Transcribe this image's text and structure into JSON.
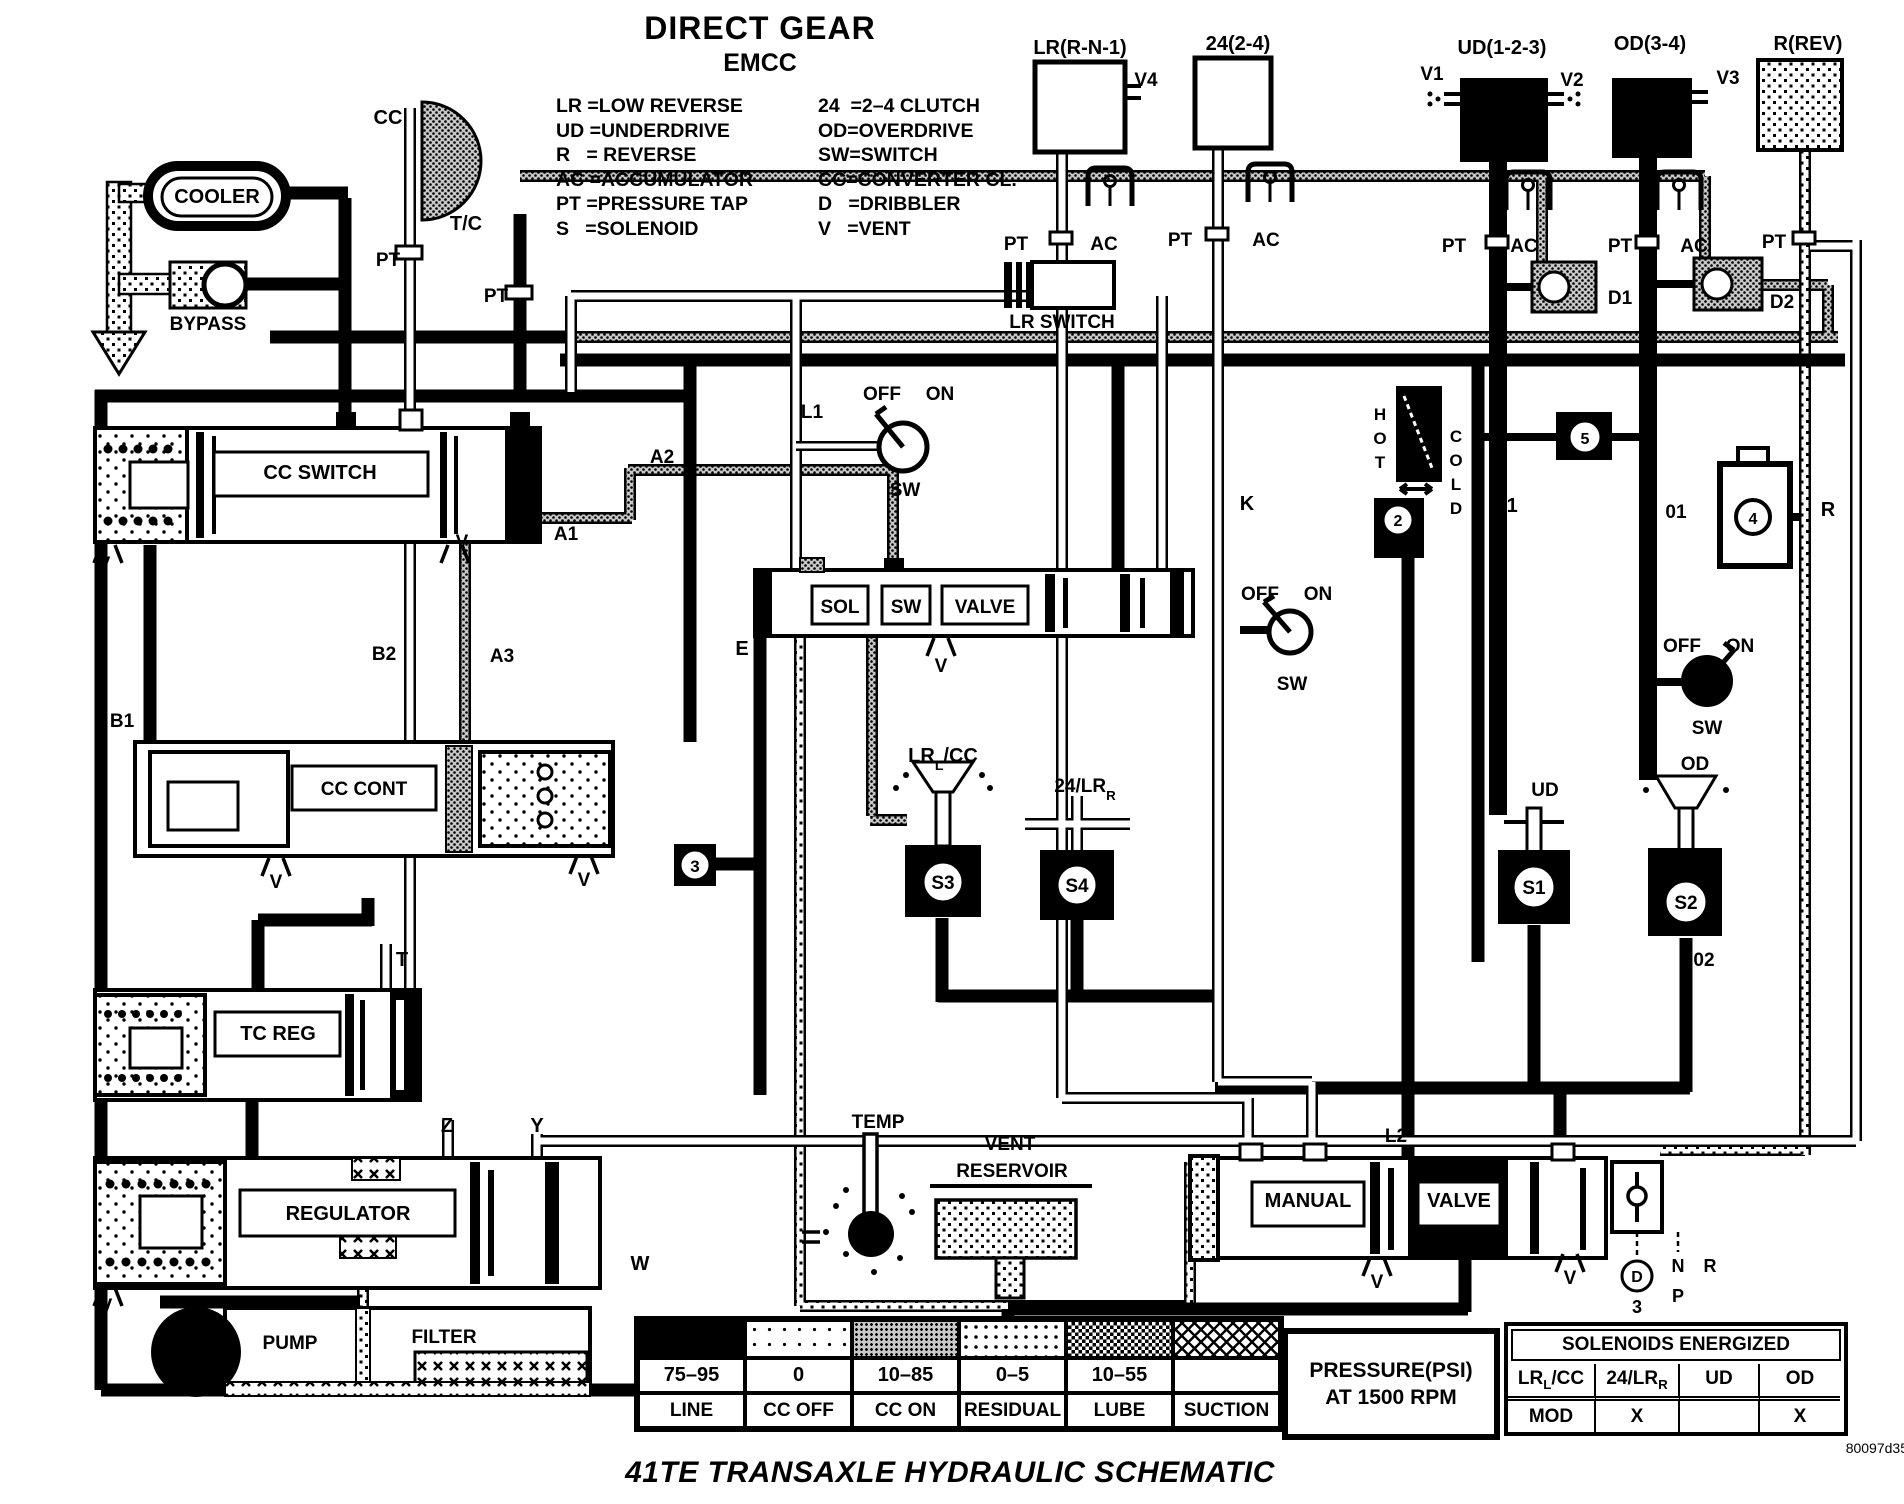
{
  "title": {
    "main": "DIRECT GEAR",
    "sub": "EMCC"
  },
  "legend": {
    "col1": [
      "LR =LOW REVERSE",
      "UD =UNDERDRIVE",
      "R   = REVERSE",
      "AC =ACCUMULATOR",
      "PT =PRESSURE TAP",
      "S   =SOLENOID"
    ],
    "col2": [
      "24  =2–4 CLUTCH",
      "OD=OVERDRIVE",
      "SW=SWITCH",
      "CC=CONVERTER CL.",
      "D   =DRIBBLER",
      "V   =VENT"
    ]
  },
  "pressure_table": {
    "title1": "PRESSURE(PSI)",
    "title2": "AT 1500 RPM",
    "columns": [
      {
        "value": "75–95",
        "label": "LINE",
        "pattern": "line"
      },
      {
        "value": "0",
        "label": "CC OFF",
        "pattern": "ccoff"
      },
      {
        "value": "10–85",
        "label": "CC ON",
        "pattern": "ccon"
      },
      {
        "value": "0–5",
        "label": "RESIDUAL",
        "pattern": "residual"
      },
      {
        "value": "10–55",
        "label": "LUBE",
        "pattern": "lube"
      },
      {
        "value": "",
        "label": "SUCTION",
        "pattern": "suction"
      }
    ]
  },
  "solenoids_table": {
    "title": "SOLENOIDS ENERGIZED",
    "headers": [
      {
        "parts": [
          {
            "t": "LR"
          },
          {
            "t": "L",
            "sub": true
          },
          {
            "t": "/CC"
          }
        ]
      },
      {
        "parts": [
          {
            "t": "24/LR"
          },
          {
            "t": "R",
            "sub": true
          }
        ]
      },
      {
        "parts": [
          {
            "t": "UD"
          }
        ]
      },
      {
        "parts": [
          {
            "t": "OD"
          }
        ]
      }
    ],
    "row": [
      "MOD",
      "X",
      "",
      "X"
    ]
  },
  "footer": {
    "title": "41TE TRANSAXLE HYDRAULIC SCHEMATIC",
    "code": "80097d35"
  },
  "accent": {
    "ink": "#000000",
    "paper": "#ffffff"
  },
  "labels": [
    {
      "id": "cc",
      "t": "CC",
      "x": 388,
      "y": 124,
      "s": 20
    },
    {
      "id": "tc-converter",
      "t": "T/C",
      "x": 466,
      "y": 230,
      "s": 20
    },
    {
      "id": "pt-cc-line",
      "t": "PT",
      "x": 388,
      "y": 266,
      "s": 19
    },
    {
      "id": "pt-tc",
      "t": "PT",
      "x": 496,
      "y": 302,
      "s": 19
    },
    {
      "id": "cooler",
      "t": "COOLER",
      "x": 217,
      "y": 203,
      "s": 20
    },
    {
      "id": "bypass",
      "t": "BYPASS",
      "x": 208,
      "y": 330,
      "s": 19
    },
    {
      "id": "cc-switch",
      "t": "CC SWITCH",
      "x": 320,
      "y": 479,
      "s": 20
    },
    {
      "id": "v-ccsw-left",
      "t": "V",
      "x": 104,
      "y": 570,
      "s": 19
    },
    {
      "id": "v-ccsw-right",
      "t": "V",
      "x": 462,
      "y": 548,
      "s": 19
    },
    {
      "id": "a1",
      "t": "A1",
      "x": 566,
      "y": 540,
      "s": 19
    },
    {
      "id": "a2",
      "t": "A2",
      "x": 662,
      "y": 463,
      "s": 19
    },
    {
      "id": "a3",
      "t": "A3",
      "x": 502,
      "y": 662,
      "s": 19
    },
    {
      "id": "b2",
      "t": "B2",
      "x": 384,
      "y": 660,
      "s": 19
    },
    {
      "id": "b1",
      "t": "B1",
      "x": 122,
      "y": 727,
      "s": 19
    },
    {
      "id": "cc-cont",
      "t": "CC CONT",
      "x": 364,
      "y": 795,
      "s": 19
    },
    {
      "id": "v-cccont-left",
      "t": "V",
      "x": 276,
      "y": 888,
      "s": 19
    },
    {
      "id": "v-cccont-right",
      "t": "V",
      "x": 584,
      "y": 886,
      "s": 19
    },
    {
      "id": "e",
      "t": "E",
      "x": 742,
      "y": 655,
      "s": 20
    },
    {
      "id": "l1",
      "t": "L1",
      "x": 812,
      "y": 418,
      "s": 19
    },
    {
      "id": "sw1-off",
      "t": "OFF",
      "x": 882,
      "y": 400,
      "s": 19
    },
    {
      "id": "sw1-on",
      "t": "ON",
      "x": 940,
      "y": 400,
      "s": 19
    },
    {
      "id": "sw1",
      "t": "SW",
      "x": 905,
      "y": 496,
      "s": 19
    },
    {
      "id": "lr-switch",
      "t": "LR SWITCH",
      "x": 1062,
      "y": 328,
      "s": 19
    },
    {
      "id": "sol-window",
      "t": "SOL",
      "x": 840,
      "y": 613,
      "s": 19
    },
    {
      "id": "sw-window",
      "t": "SW",
      "x": 906,
      "y": 613,
      "s": 19
    },
    {
      "id": "valve-window",
      "t": "VALVE",
      "x": 985,
      "y": 613,
      "s": 19
    },
    {
      "id": "v-solvalve",
      "t": "V",
      "x": 941,
      "y": 672,
      "s": 19
    },
    {
      "id": "lrl-cc",
      "x": 943,
      "y": 762,
      "s": 20,
      "parts": [
        {
          "t": "LR"
        },
        {
          "t": "L",
          "sub": true
        },
        {
          "t": "/CC"
        }
      ]
    },
    {
      "id": "s3",
      "t": "S3",
      "x": 943,
      "y": 889,
      "s": 19
    },
    {
      "id": "n24-lrr",
      "x": 1085,
      "y": 792,
      "s": 19,
      "parts": [
        {
          "t": "24/LR"
        },
        {
          "t": "R",
          "sub": true
        }
      ]
    },
    {
      "id": "s4",
      "t": "S4",
      "x": 1077,
      "y": 892,
      "s": 19
    },
    {
      "id": "c3",
      "t": "3",
      "x": 695,
      "y": 872,
      "s": 17
    },
    {
      "id": "k",
      "t": "K",
      "x": 1247,
      "y": 510,
      "s": 20
    },
    {
      "id": "sw2-off",
      "t": "OFF",
      "x": 1260,
      "y": 600,
      "s": 19
    },
    {
      "id": "sw2-on",
      "t": "ON",
      "x": 1318,
      "y": 600,
      "s": 19
    },
    {
      "id": "sw2",
      "t": "SW",
      "x": 1292,
      "y": 690,
      "s": 19
    },
    {
      "id": "hot-h",
      "t": "H",
      "x": 1380,
      "y": 420,
      "s": 17
    },
    {
      "id": "hot-o",
      "t": "O",
      "x": 1380,
      "y": 444,
      "s": 17
    },
    {
      "id": "hot-t",
      "t": "T",
      "x": 1380,
      "y": 468,
      "s": 17
    },
    {
      "id": "cold-c",
      "t": "C",
      "x": 1456,
      "y": 442,
      "s": 17
    },
    {
      "id": "cold-o",
      "t": "O",
      "x": 1456,
      "y": 466,
      "s": 17
    },
    {
      "id": "cold-l",
      "t": "L",
      "x": 1456,
      "y": 490,
      "s": 17
    },
    {
      "id": "cold-d",
      "t": "D",
      "x": 1456,
      "y": 514,
      "s": 17
    },
    {
      "id": "c2",
      "t": "2",
      "x": 1398,
      "y": 526,
      "s": 16
    },
    {
      "id": "u1",
      "t": "U1",
      "x": 1505,
      "y": 512,
      "s": 20
    },
    {
      "id": "c5",
      "t": "5",
      "x": 1585,
      "y": 444,
      "s": 16
    },
    {
      "id": "o1",
      "t": "01",
      "x": 1676,
      "y": 518,
      "s": 19
    },
    {
      "id": "c4",
      "t": "4",
      "x": 1753,
      "y": 524,
      "s": 16
    },
    {
      "id": "r-mid",
      "t": "R",
      "x": 1828,
      "y": 516,
      "s": 20
    },
    {
      "id": "sw3-off",
      "t": "OFF",
      "x": 1682,
      "y": 652,
      "s": 19
    },
    {
      "id": "sw3-on",
      "t": "ON",
      "x": 1740,
      "y": 652,
      "s": 19
    },
    {
      "id": "sw3",
      "t": "SW",
      "x": 1707,
      "y": 734,
      "s": 19
    },
    {
      "id": "ud-s1",
      "t": "UD",
      "x": 1545,
      "y": 796,
      "s": 19
    },
    {
      "id": "s1",
      "t": "S1",
      "x": 1534,
      "y": 894,
      "s": 19
    },
    {
      "id": "od-s2",
      "t": "OD",
      "x": 1695,
      "y": 770,
      "s": 19
    },
    {
      "id": "s2",
      "t": "S2",
      "x": 1686,
      "y": 909,
      "s": 19
    },
    {
      "id": "o2",
      "t": "02",
      "x": 1704,
      "y": 966,
      "s": 19
    },
    {
      "id": "lr-acc-title",
      "t": "LR(R-N-1)",
      "x": 1080,
      "y": 54,
      "s": 20
    },
    {
      "id": "acc24-title",
      "t": "24(2-4)",
      "x": 1238,
      "y": 50,
      "s": 20
    },
    {
      "id": "ud-acc-title",
      "t": "UD(1-2-3)",
      "x": 1502,
      "y": 54,
      "s": 20
    },
    {
      "id": "od-acc-title",
      "t": "OD(3-4)",
      "x": 1650,
      "y": 50,
      "s": 20
    },
    {
      "id": "r-acc-title",
      "t": "R(REV)",
      "x": 1808,
      "y": 50,
      "s": 20
    },
    {
      "id": "v4",
      "t": "V4",
      "x": 1146,
      "y": 86,
      "s": 19
    },
    {
      "id": "v1",
      "t": "V1",
      "x": 1432,
      "y": 80,
      "s": 19
    },
    {
      "id": "v2",
      "t": "V2",
      "x": 1572,
      "y": 86,
      "s": 19
    },
    {
      "id": "v3",
      "t": "V3",
      "x": 1728,
      "y": 84,
      "s": 19
    },
    {
      "id": "pt-lr",
      "t": "PT",
      "x": 1016,
      "y": 250,
      "s": 19
    },
    {
      "id": "ac-lr",
      "t": "AC",
      "x": 1104,
      "y": 250,
      "s": 19
    },
    {
      "id": "pt-24",
      "t": "PT",
      "x": 1180,
      "y": 246,
      "s": 19
    },
    {
      "id": "ac-24",
      "t": "AC",
      "x": 1266,
      "y": 246,
      "s": 19
    },
    {
      "id": "pt-ud",
      "t": "PT",
      "x": 1454,
      "y": 252,
      "s": 19
    },
    {
      "id": "ac-ud",
      "t": "AC",
      "x": 1524,
      "y": 252,
      "s": 19
    },
    {
      "id": "pt-od",
      "t": "PT",
      "x": 1620,
      "y": 252,
      "s": 19
    },
    {
      "id": "ac-od",
      "t": "AC",
      "x": 1694,
      "y": 252,
      "s": 19
    },
    {
      "id": "pt-r",
      "t": "PT",
      "x": 1774,
      "y": 248,
      "s": 19
    },
    {
      "id": "d1",
      "t": "D1",
      "x": 1620,
      "y": 304,
      "s": 19
    },
    {
      "id": "d2",
      "t": "D2",
      "x": 1782,
      "y": 308,
      "s": 19
    },
    {
      "id": "t",
      "t": "T",
      "x": 402,
      "y": 966,
      "s": 20
    },
    {
      "id": "tc-reg",
      "t": "TC REG",
      "x": 278,
      "y": 1040,
      "s": 20
    },
    {
      "id": "z",
      "t": "Z",
      "x": 447,
      "y": 1132,
      "s": 20
    },
    {
      "id": "y",
      "t": "Y",
      "x": 537,
      "y": 1132,
      "s": 20
    },
    {
      "id": "regulator",
      "t": "REGULATOR",
      "x": 348,
      "y": 1220,
      "s": 20
    },
    {
      "id": "v-reg",
      "t": "V",
      "x": 106,
      "y": 1312,
      "s": 19
    },
    {
      "id": "w",
      "t": "W",
      "x": 640,
      "y": 1270,
      "s": 20
    },
    {
      "id": "temp",
      "t": "TEMP",
      "x": 878,
      "y": 1128,
      "s": 19
    },
    {
      "id": "vent",
      "t": "VENT",
      "x": 1010,
      "y": 1150,
      "s": 19
    },
    {
      "id": "reservoir",
      "t": "RESERVOIR",
      "x": 1012,
      "y": 1177,
      "s": 19
    },
    {
      "id": "l2",
      "t": "L2",
      "x": 1396,
      "y": 1142,
      "s": 19
    },
    {
      "id": "manual",
      "t": "MANUAL",
      "x": 1308,
      "y": 1207,
      "s": 20
    },
    {
      "id": "valve2",
      "t": "VALVE",
      "x": 1459,
      "y": 1207,
      "s": 20
    },
    {
      "id": "v-manual-left",
      "t": "V",
      "x": 1377,
      "y": 1288,
      "s": 19
    },
    {
      "id": "v-manual-right",
      "t": "V",
      "x": 1570,
      "y": 1284,
      "s": 19
    },
    {
      "id": "gear-d",
      "t": "D",
      "x": 1637,
      "y": 1282,
      "s": 16
    },
    {
      "id": "gear-3",
      "t": "3",
      "x": 1637,
      "y": 1313,
      "s": 18
    },
    {
      "id": "gear-l",
      "t": "L",
      "x": 1637,
      "y": 1342,
      "s": 18
    },
    {
      "id": "gear-n",
      "t": "N",
      "x": 1678,
      "y": 1272,
      "s": 18
    },
    {
      "id": "gear-p",
      "t": "P",
      "x": 1678,
      "y": 1302,
      "s": 18
    },
    {
      "id": "gear-r",
      "t": "R",
      "x": 1710,
      "y": 1272,
      "s": 18
    },
    {
      "id": "pump",
      "t": "PUMP",
      "x": 290,
      "y": 1349,
      "s": 19
    },
    {
      "id": "filter",
      "t": "FILTER",
      "x": 444,
      "y": 1343,
      "s": 19
    }
  ]
}
